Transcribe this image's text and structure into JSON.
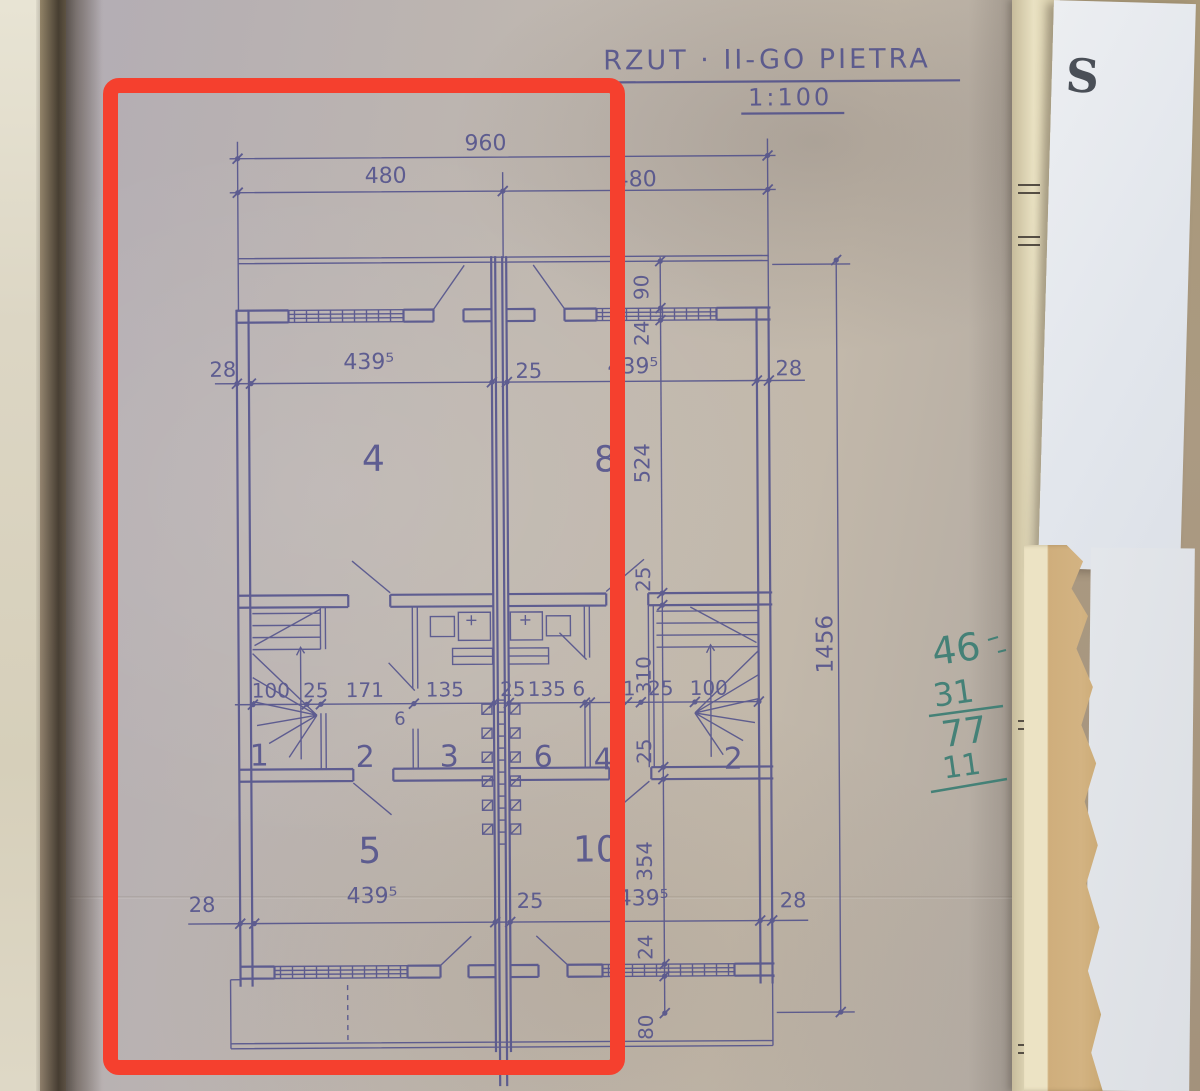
{
  "colors": {
    "ink": "#4c4c8a",
    "annotation_red": "#f5402e",
    "handwriting_green": "#3c7e74"
  },
  "title": {
    "text": "RZUT · II-GO PIETRA",
    "scale": "1:100"
  },
  "corner_letter": "S",
  "handwriting": {
    "v1": "46",
    "v2": "31",
    "v3": "77",
    "v4": "11"
  },
  "rooms": {
    "r4": "4",
    "r8": "8",
    "r1": "1",
    "r2": "2",
    "r3": "3",
    "r6": "6",
    "r7": "4",
    "r9": "2",
    "r5": "5",
    "r10": "10"
  },
  "dims": {
    "top_overall": "960",
    "top_left": "480",
    "top_right": "480",
    "u1": "28",
    "u2": "439⁵",
    "u3": "25",
    "u4": "439⁵",
    "u5": "28",
    "m1": "100",
    "m2": "25",
    "m3": "171",
    "m4": "135",
    "m5": "25",
    "m6": "135",
    "m7": "6",
    "m8": "71",
    "m9": "25",
    "m10": "100",
    "m_wall": "6",
    "b1": "28",
    "b2": "439⁵",
    "b3": "25",
    "b4": "439⁵",
    "b5": "28",
    "c1": "90",
    "c2": "24",
    "c3": "524",
    "c4": "25",
    "c5": "310",
    "c6": "25",
    "c7": "354",
    "c8": "24",
    "c9": "80",
    "overall_height": "1456"
  }
}
